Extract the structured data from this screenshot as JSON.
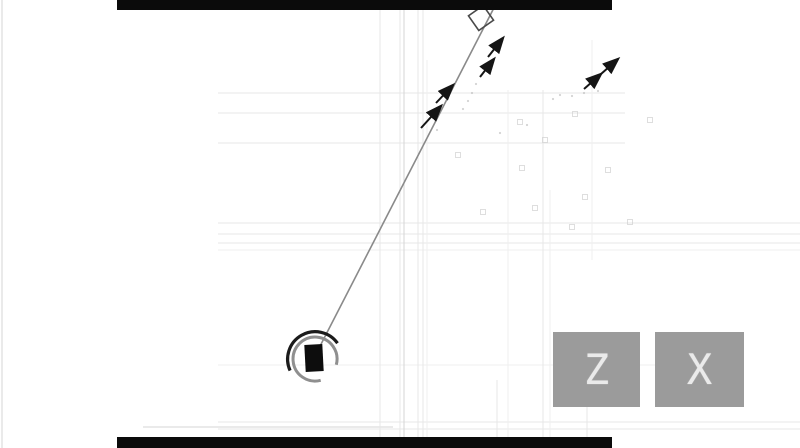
{
  "buttons": [
    {
      "label": "Z"
    },
    {
      "label": "X"
    }
  ],
  "colors": {
    "background": "#ffffff",
    "letterbox": "#0b0b0b",
    "button_bg": "#9b9b9b",
    "button_text": "#f1f1f1",
    "aim_line": "#8a8a8a",
    "arrow": "#151515",
    "player_square": "#0d0d0d",
    "player_arc_dark": "#1b1b1b",
    "player_arc_light": "#8f8f8f",
    "target_square_stroke": "#4a4a4a",
    "grid_default": "#e7e7e7",
    "grid_dark": "#d5d5d5",
    "grid_light": "#efefef",
    "particle_square": "#d0d0d0",
    "particle_dot": "#b8b8b8"
  },
  "scene": {
    "letterbox_bars": [
      {
        "x": 117,
        "y": 0,
        "w": 495,
        "h": 10
      },
      {
        "x": 117,
        "y": 437,
        "w": 495,
        "h": 11
      }
    ],
    "grid": {
      "h_lines": [
        {
          "y": 93,
          "x1": 218,
          "x2": 625,
          "tone": "default"
        },
        {
          "y": 113,
          "x1": 218,
          "x2": 625,
          "tone": "default"
        },
        {
          "y": 143,
          "x1": 218,
          "x2": 625,
          "tone": "default"
        },
        {
          "y": 223,
          "x1": 218,
          "x2": 800,
          "tone": "default"
        },
        {
          "y": 234,
          "x1": 218,
          "x2": 800,
          "tone": "default"
        },
        {
          "y": 243,
          "x1": 218,
          "x2": 800,
          "tone": "default"
        },
        {
          "y": 250,
          "x1": 218,
          "x2": 800,
          "tone": "light"
        },
        {
          "y": 365,
          "x1": 218,
          "x2": 655,
          "tone": "light"
        },
        {
          "y": 422,
          "x1": 218,
          "x2": 800,
          "tone": "default"
        },
        {
          "y": 427,
          "x1": 143,
          "x2": 393,
          "tone": "dark"
        },
        {
          "y": 429,
          "x1": 218,
          "x2": 800,
          "tone": "default"
        }
      ],
      "v_lines": [
        {
          "x": 2,
          "y1": 0,
          "y2": 448,
          "tone": "dark"
        },
        {
          "x": 380,
          "y1": 0,
          "y2": 448,
          "tone": "default"
        },
        {
          "x": 400,
          "y1": 0,
          "y2": 448,
          "tone": "default"
        },
        {
          "x": 404,
          "y1": 0,
          "y2": 448,
          "tone": "dark"
        },
        {
          "x": 418,
          "y1": 0,
          "y2": 448,
          "tone": "default"
        },
        {
          "x": 423,
          "y1": 0,
          "y2": 448,
          "tone": "default"
        },
        {
          "x": 427,
          "y1": 60,
          "y2": 448,
          "tone": "light"
        },
        {
          "x": 497,
          "y1": 380,
          "y2": 448,
          "tone": "default"
        },
        {
          "x": 508,
          "y1": 90,
          "y2": 448,
          "tone": "light"
        },
        {
          "x": 543,
          "y1": 90,
          "y2": 448,
          "tone": "default"
        },
        {
          "x": 550,
          "y1": 190,
          "y2": 448,
          "tone": "light"
        },
        {
          "x": 587,
          "y1": 380,
          "y2": 448,
          "tone": "default"
        },
        {
          "x": 592,
          "y1": 40,
          "y2": 260,
          "tone": "light"
        }
      ]
    },
    "aim_line": {
      "x1": 317,
      "y1": 352,
      "x2": 498,
      "y2": 0,
      "width": 1.6
    },
    "target_square": {
      "cx": 481,
      "cy": 18,
      "size": 18,
      "rotation": -35,
      "stroke_width": 1.6
    },
    "player": {
      "square": {
        "cx": 314,
        "cy": 358,
        "w": 18,
        "h": 27,
        "rotation": -3
      },
      "arc_dark": {
        "d": "M337.5 343.2 A27.5 27.5 0 0 0 290.1 370.6",
        "width": 3.2
      },
      "arc_light": {
        "d": "M336.3 364.7 A22 22 0 1 0 320.7 380.3",
        "width": 3
      }
    },
    "arrows": [
      {
        "pts": [
          [
            421,
            128
          ],
          [
            441,
            106
          ]
        ],
        "double": false
      },
      {
        "pts": [
          [
            436,
            103
          ],
          [
            453,
            85
          ]
        ],
        "double": false
      },
      {
        "pts": [
          [
            480,
            77
          ],
          [
            494,
            59
          ]
        ],
        "double": false
      },
      {
        "pts": [
          [
            488,
            57
          ],
          [
            503,
            38
          ]
        ],
        "double": false
      },
      {
        "pts": [
          [
            584,
            89
          ],
          [
            601,
            74
          ],
          [
            618,
            59
          ]
        ],
        "double": true
      }
    ],
    "particles": {
      "squares": [
        [
          520,
          122
        ],
        [
          575,
          114
        ],
        [
          458,
          155
        ],
        [
          522,
          168
        ],
        [
          608,
          170
        ],
        [
          535,
          208
        ],
        [
          585,
          197
        ],
        [
          483,
          212
        ],
        [
          572,
          227
        ],
        [
          630,
          222
        ],
        [
          650,
          120
        ],
        [
          545,
          140
        ]
      ],
      "dots": [
        [
          500,
          133
        ],
        [
          560,
          95
        ],
        [
          572,
          96
        ],
        [
          584,
          93
        ],
        [
          598,
          91
        ],
        [
          476,
          84
        ],
        [
          472,
          93
        ],
        [
          468,
          101
        ],
        [
          463,
          109
        ],
        [
          437,
          130
        ],
        [
          527,
          125
        ],
        [
          553,
          99
        ]
      ]
    }
  },
  "button_layout": [
    {
      "x": 553,
      "y": 332,
      "w": 87,
      "h": 75
    },
    {
      "x": 655,
      "y": 332,
      "w": 89,
      "h": 75
    }
  ]
}
